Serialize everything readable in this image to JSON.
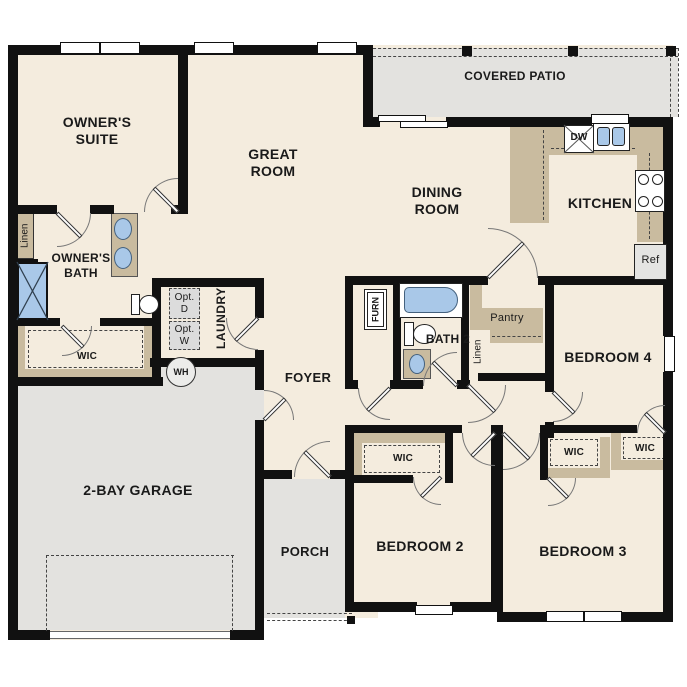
{
  "floor_plan": {
    "rooms": {
      "owners_suite": "OWNER'S SUITE",
      "great_room": "GREAT ROOM",
      "covered_patio": "COVERED PATIO",
      "dining_room": "DINING ROOM",
      "kitchen": "KITCHEN",
      "owners_bath": "OWNER'S BATH",
      "laundry": "LAUNDRY",
      "foyer": "FOYER",
      "garage": "2-BAY GARAGE",
      "porch": "PORCH",
      "bedroom2": "BEDROOM 2",
      "bedroom3": "BEDROOM 3",
      "bedroom4": "BEDROOM 4",
      "bath2": "BATH 2"
    },
    "closets": {
      "linen_owners": "Linen",
      "linen_hall": "Linen",
      "wic_owners": "WIC",
      "wic_bedroom2": "WIC",
      "wic_bedroom3": "WIC",
      "wic_bedroom4": "WIC",
      "pantry": "Pantry"
    },
    "equipment": {
      "furnace": "FURN",
      "water_heater": "WH",
      "dishwasher": "DW",
      "refrigerator": "Ref",
      "optional_dryer": "Opt. D",
      "optional_washer": "Opt. W"
    },
    "colors": {
      "wall": "#111111",
      "interior": "#f4ecde",
      "exterior_concrete": "#e3e2df",
      "casework_tan": "#c9bb9f",
      "fixture_blue": "#a9c8e8",
      "appliance_gray": "#dcdcdc"
    }
  }
}
